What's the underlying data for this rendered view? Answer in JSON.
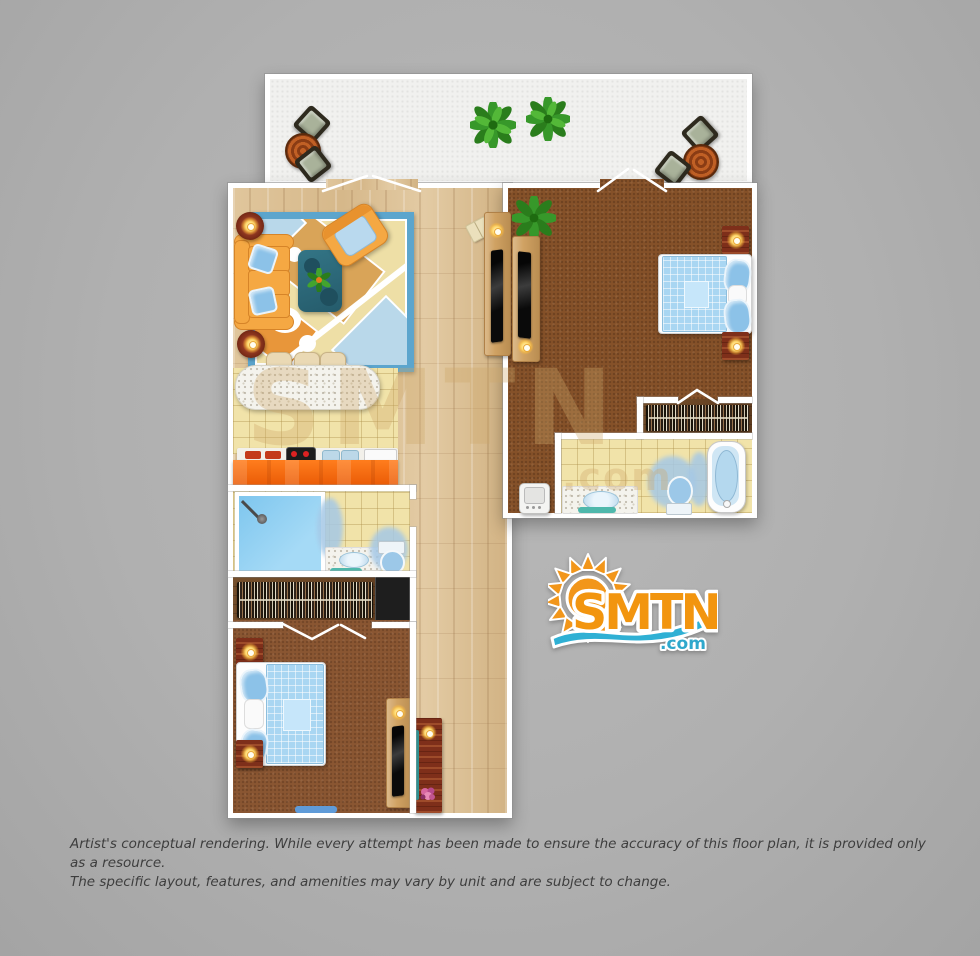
{
  "canvas": {
    "width": 980,
    "height": 956,
    "background_gray": "#b0b0b0"
  },
  "branding": {
    "logo": {
      "name": "SMTN",
      "tld": ".com",
      "orange": "#f2950f",
      "blue": "#2fb0d4"
    },
    "watermark": {
      "text": "SMTN",
      "tld": ".com"
    }
  },
  "disclaimer": {
    "line1": "Artist's conceptual rendering. While every attempt has been made to ensure the accuracy of this floor plan, it is provided only as a resource.",
    "line2": "The specific layout, features, and amenities may vary by unit and are subject to change."
  },
  "floor_plan": {
    "type": "top-view residential suite rendering",
    "areas": [
      {
        "name": "balcony",
        "floor": "white concrete",
        "furniture": [
          "bistro chair",
          "round table",
          "bistro chair",
          "potted plant",
          "potted plant",
          "bistro chair",
          "round table",
          "bistro chair"
        ]
      },
      {
        "name": "living-room",
        "floor": "hardwood",
        "furniture": [
          "orange sofa with two blue pillows",
          "orange armchair",
          "teal coffee table with plant",
          "patterned area rug",
          "round side table with lamp",
          "round side table with lamp",
          "tv console with flat tv",
          "magazine on floor"
        ]
      },
      {
        "name": "kitchen",
        "floor": "yellow tile",
        "furniture": [
          "granite breakfast bar",
          "bar stool",
          "bar stool",
          "bar stool",
          "range with burners",
          "double sink",
          "cutting board",
          "orange counter"
        ]
      },
      {
        "name": "bathroom-1",
        "floor": "yellow tile",
        "fixtures": [
          "walk-in shower",
          "vanity with sink",
          "toilet",
          "bath mats"
        ]
      },
      {
        "name": "closet-1",
        "contents": [
          "hanging clothes",
          "built-in black unit"
        ]
      },
      {
        "name": "bedroom-1",
        "floor": "brown carpet",
        "furniture": [
          "double bed with blue checkered duvet",
          "nightstand with lamp",
          "nightstand with lamp",
          "tv console with flat tv",
          "blue door mat"
        ]
      },
      {
        "name": "hallway",
        "floor": "hardwood",
        "furniture": [
          "console table with lamp and flowers"
        ]
      },
      {
        "name": "bedroom-2",
        "floor": "brown carpet",
        "furniture": [
          "double bed with blue checkered duvet",
          "nightstand with lamp",
          "nightstand with lamp",
          "tv console with flat tv",
          "potted plant",
          "mini fridge"
        ]
      },
      {
        "name": "closet-2",
        "contents": [
          "hanging clothes"
        ]
      },
      {
        "name": "bathroom-2",
        "floor": "yellow tile",
        "fixtures": [
          "vanity with sink",
          "toilet",
          "bathtub",
          "bath mats"
        ]
      }
    ]
  },
  "palette": {
    "wall": "#ffffff",
    "hardwood": "#dcc096",
    "carpet": "#8a5632",
    "tile": "#f1e3a9",
    "counter_orange": "#f66a0c",
    "water_blue": "#7ec6ee",
    "rug_border_blue": "#5ca5cd",
    "sofa_orange": "#f5a843",
    "dark_wood": "#7e2f1a"
  }
}
